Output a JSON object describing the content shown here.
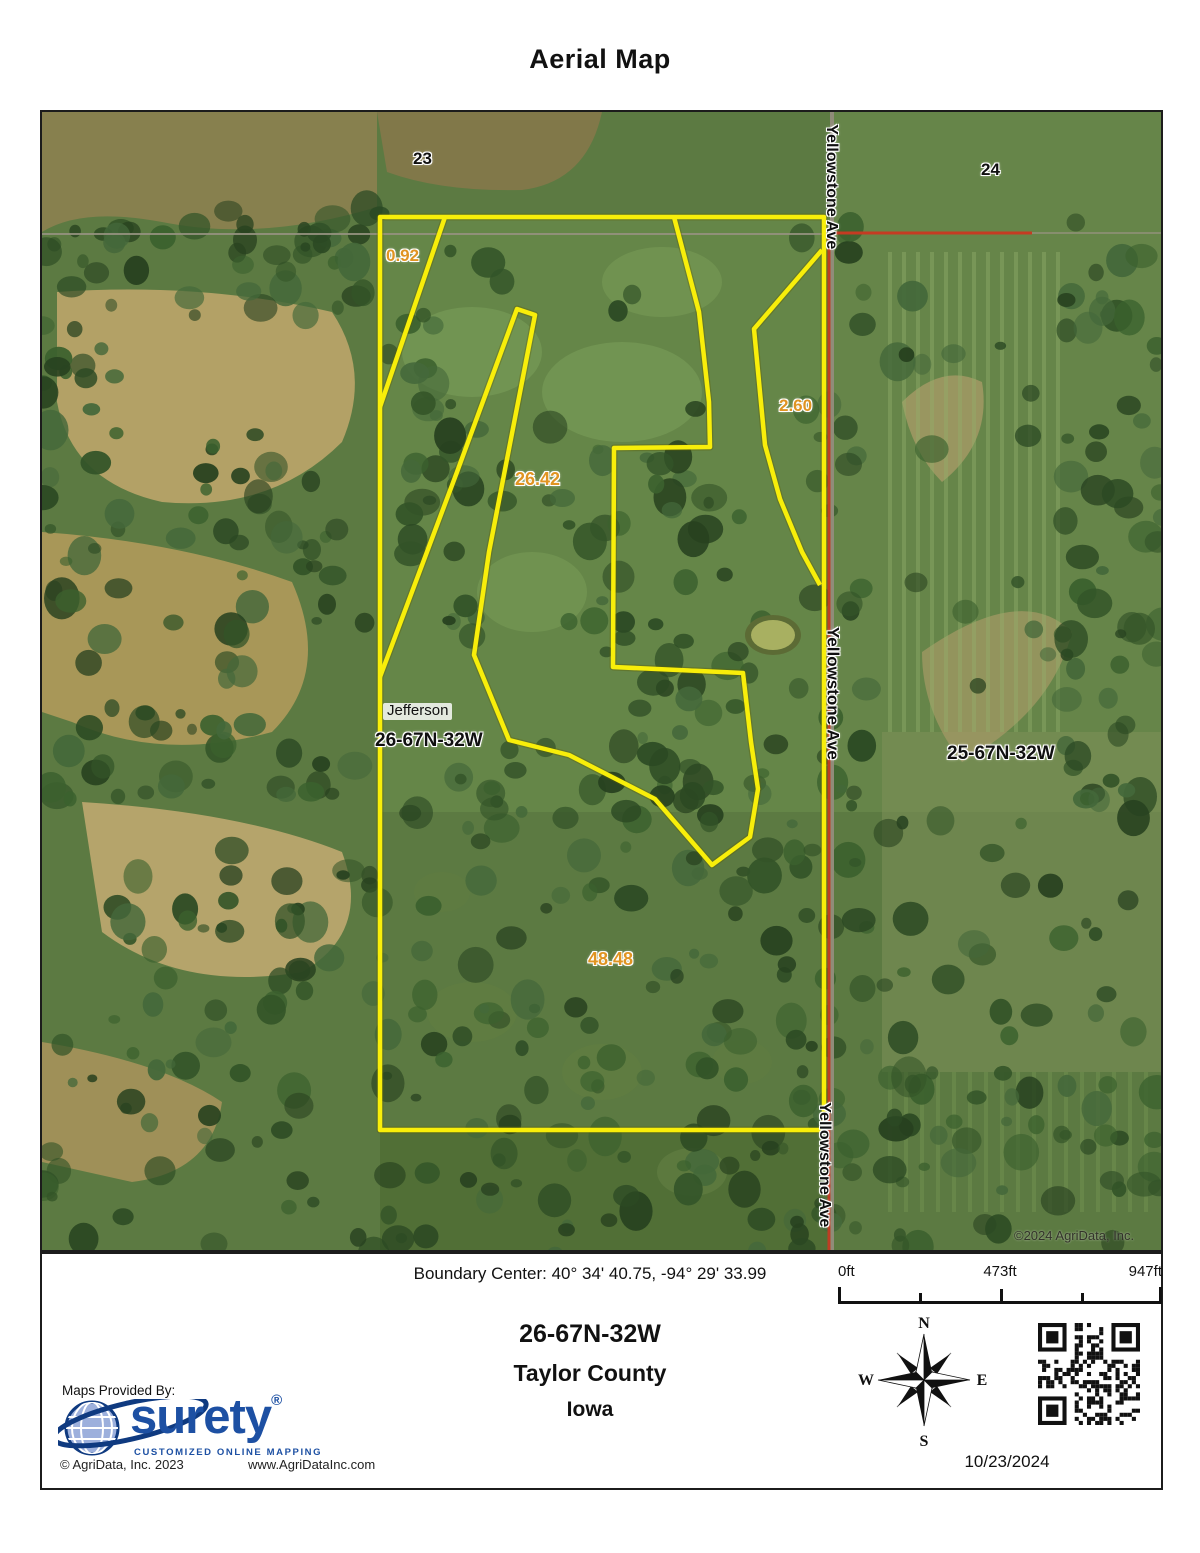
{
  "page": {
    "title": "Aerial Map"
  },
  "map": {
    "section_labels": {
      "nw": "23",
      "ne": "24"
    },
    "acreage_labels": {
      "a": "0.92",
      "b": "2.60",
      "c": "26.42",
      "d": "48.48"
    },
    "place_labels": {
      "town": "Jefferson",
      "township_here": "26-67N-32W",
      "township_east": "25-67N-32W",
      "road": "Yellowstone Ave"
    },
    "copyright": "©2024 AgriData, Inc.",
    "colors": {
      "boundary": "#f8ee0a",
      "acreage_text": "#e09422",
      "road_overlay": "#c43b22"
    }
  },
  "footer": {
    "boundary_center": "Boundary Center: 40° 34' 40.75,  -94° 29' 33.99",
    "scale": {
      "start": "0ft",
      "mid": "473ft",
      "end": "947ft"
    },
    "township": "26-67N-32W",
    "county": "Taylor County",
    "state": "Iowa",
    "compass": {
      "n": "N",
      "e": "E",
      "s": "S",
      "w": "W"
    },
    "provider": {
      "label": "Maps Provided By:",
      "brand": "surety",
      "registered": "®",
      "tagline": "CUSTOMIZED ONLINE MAPPING",
      "copyright": "© AgriData, Inc. 2023",
      "website": "www.AgriDataInc.com"
    },
    "date": "10/23/2024"
  }
}
